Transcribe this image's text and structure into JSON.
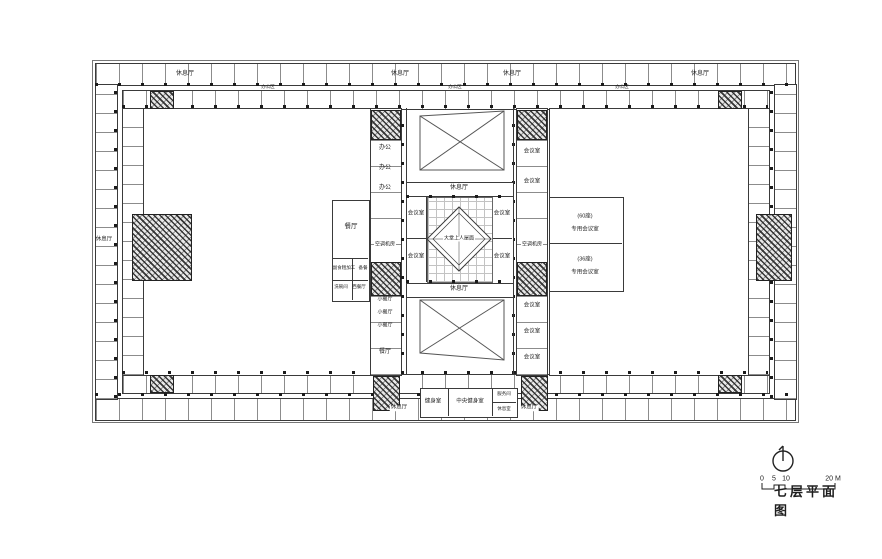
{
  "meta": {
    "drawing_type": "architectural-floor-plan",
    "line_color": "#3a3a3a",
    "background": "#ffffff",
    "hatch_color": "#232323"
  },
  "titleblock": {
    "title": "七层平面图",
    "compass_icon": "north-arrow-icon",
    "scale_ticks": {
      "t0": "0",
      "t5": "5",
      "t10": "10",
      "t20": "20 M"
    }
  },
  "plan": {
    "labels": [
      {
        "text": "休息厅",
        "x": 185,
        "y": 74,
        "fs": 6
      },
      {
        "text": "休息厅",
        "x": 400,
        "y": 74,
        "fs": 6
      },
      {
        "text": "休息厅",
        "x": 512,
        "y": 74,
        "fs": 6
      },
      {
        "text": "休息厅",
        "x": 700,
        "y": 74,
        "fs": 6
      },
      {
        "text": "办公区",
        "x": 268,
        "y": 87,
        "fs": 4.5
      },
      {
        "text": "办公区",
        "x": 455,
        "y": 87,
        "fs": 4.5
      },
      {
        "text": "办公区",
        "x": 622,
        "y": 87,
        "fs": 4.5
      },
      {
        "text": "休息厅",
        "x": 104,
        "y": 240,
        "fs": 5.5
      },
      {
        "text": "办公",
        "x": 385,
        "y": 148,
        "fs": 6
      },
      {
        "text": "办公",
        "x": 385,
        "y": 168,
        "fs": 6
      },
      {
        "text": "办公",
        "x": 385,
        "y": 188,
        "fs": 6
      },
      {
        "text": "空调机房",
        "x": 385,
        "y": 245,
        "fs": 5,
        "bg": true
      },
      {
        "text": "小餐厅",
        "x": 385,
        "y": 300,
        "fs": 5,
        "bg": true
      },
      {
        "text": "小餐厅",
        "x": 385,
        "y": 313,
        "fs": 5,
        "bg": true
      },
      {
        "text": "小餐厅",
        "x": 385,
        "y": 326,
        "fs": 5,
        "bg": true
      },
      {
        "text": "餐厅",
        "x": 385,
        "y": 352,
        "fs": 6,
        "bg": true
      },
      {
        "text": "餐厅",
        "x": 351,
        "y": 227,
        "fs": 6.5
      },
      {
        "text": "副食粗加工",
        "x": 344,
        "y": 268,
        "fs": 4.5
      },
      {
        "text": "备餐",
        "x": 363,
        "y": 268,
        "fs": 4.5
      },
      {
        "text": "洗碗间",
        "x": 341,
        "y": 287,
        "fs": 4.5
      },
      {
        "text": "西餐厅",
        "x": 359,
        "y": 287,
        "fs": 4.5
      },
      {
        "text": "会议室",
        "x": 416,
        "y": 214,
        "fs": 5.5
      },
      {
        "text": "会议室",
        "x": 416,
        "y": 257,
        "fs": 5.5
      },
      {
        "text": "会议室",
        "x": 502,
        "y": 214,
        "fs": 5.5
      },
      {
        "text": "会议室",
        "x": 502,
        "y": 257,
        "fs": 5.5
      },
      {
        "text": "休息厅",
        "x": 459,
        "y": 188,
        "fs": 6
      },
      {
        "text": "休息厅",
        "x": 459,
        "y": 289,
        "fs": 6
      },
      {
        "text": "大堂上人屋面",
        "x": 459,
        "y": 239,
        "fs": 5,
        "bg": true
      },
      {
        "text": "会议室",
        "x": 532,
        "y": 152,
        "fs": 5.5
      },
      {
        "text": "会议室",
        "x": 532,
        "y": 182,
        "fs": 5.5
      },
      {
        "text": "空调机房",
        "x": 532,
        "y": 245,
        "fs": 5,
        "bg": true
      },
      {
        "text": "会议室",
        "x": 532,
        "y": 306,
        "fs": 5.5
      },
      {
        "text": "会议室",
        "x": 532,
        "y": 332,
        "fs": 5.5
      },
      {
        "text": "会议室",
        "x": 532,
        "y": 358,
        "fs": 5.5
      },
      {
        "text": "(60座)",
        "x": 585,
        "y": 217,
        "fs": 5.5
      },
      {
        "text": "专用会议室",
        "x": 585,
        "y": 230,
        "fs": 5.5
      },
      {
        "text": "(36座)",
        "x": 585,
        "y": 260,
        "fs": 5.5
      },
      {
        "text": "专用会议室",
        "x": 585,
        "y": 273,
        "fs": 5.5
      },
      {
        "text": "休息厅",
        "x": 399,
        "y": 408,
        "fs": 5.5,
        "bg": true
      },
      {
        "text": "健身室",
        "x": 433,
        "y": 402,
        "fs": 5.5
      },
      {
        "text": "中央健身室",
        "x": 470,
        "y": 402,
        "fs": 5.5
      },
      {
        "text": "服务间",
        "x": 504,
        "y": 394,
        "fs": 4.5
      },
      {
        "text": "休息室",
        "x": 504,
        "y": 409,
        "fs": 4.5
      },
      {
        "text": "休息厅",
        "x": 529,
        "y": 408,
        "fs": 5.5,
        "bg": true
      }
    ]
  }
}
